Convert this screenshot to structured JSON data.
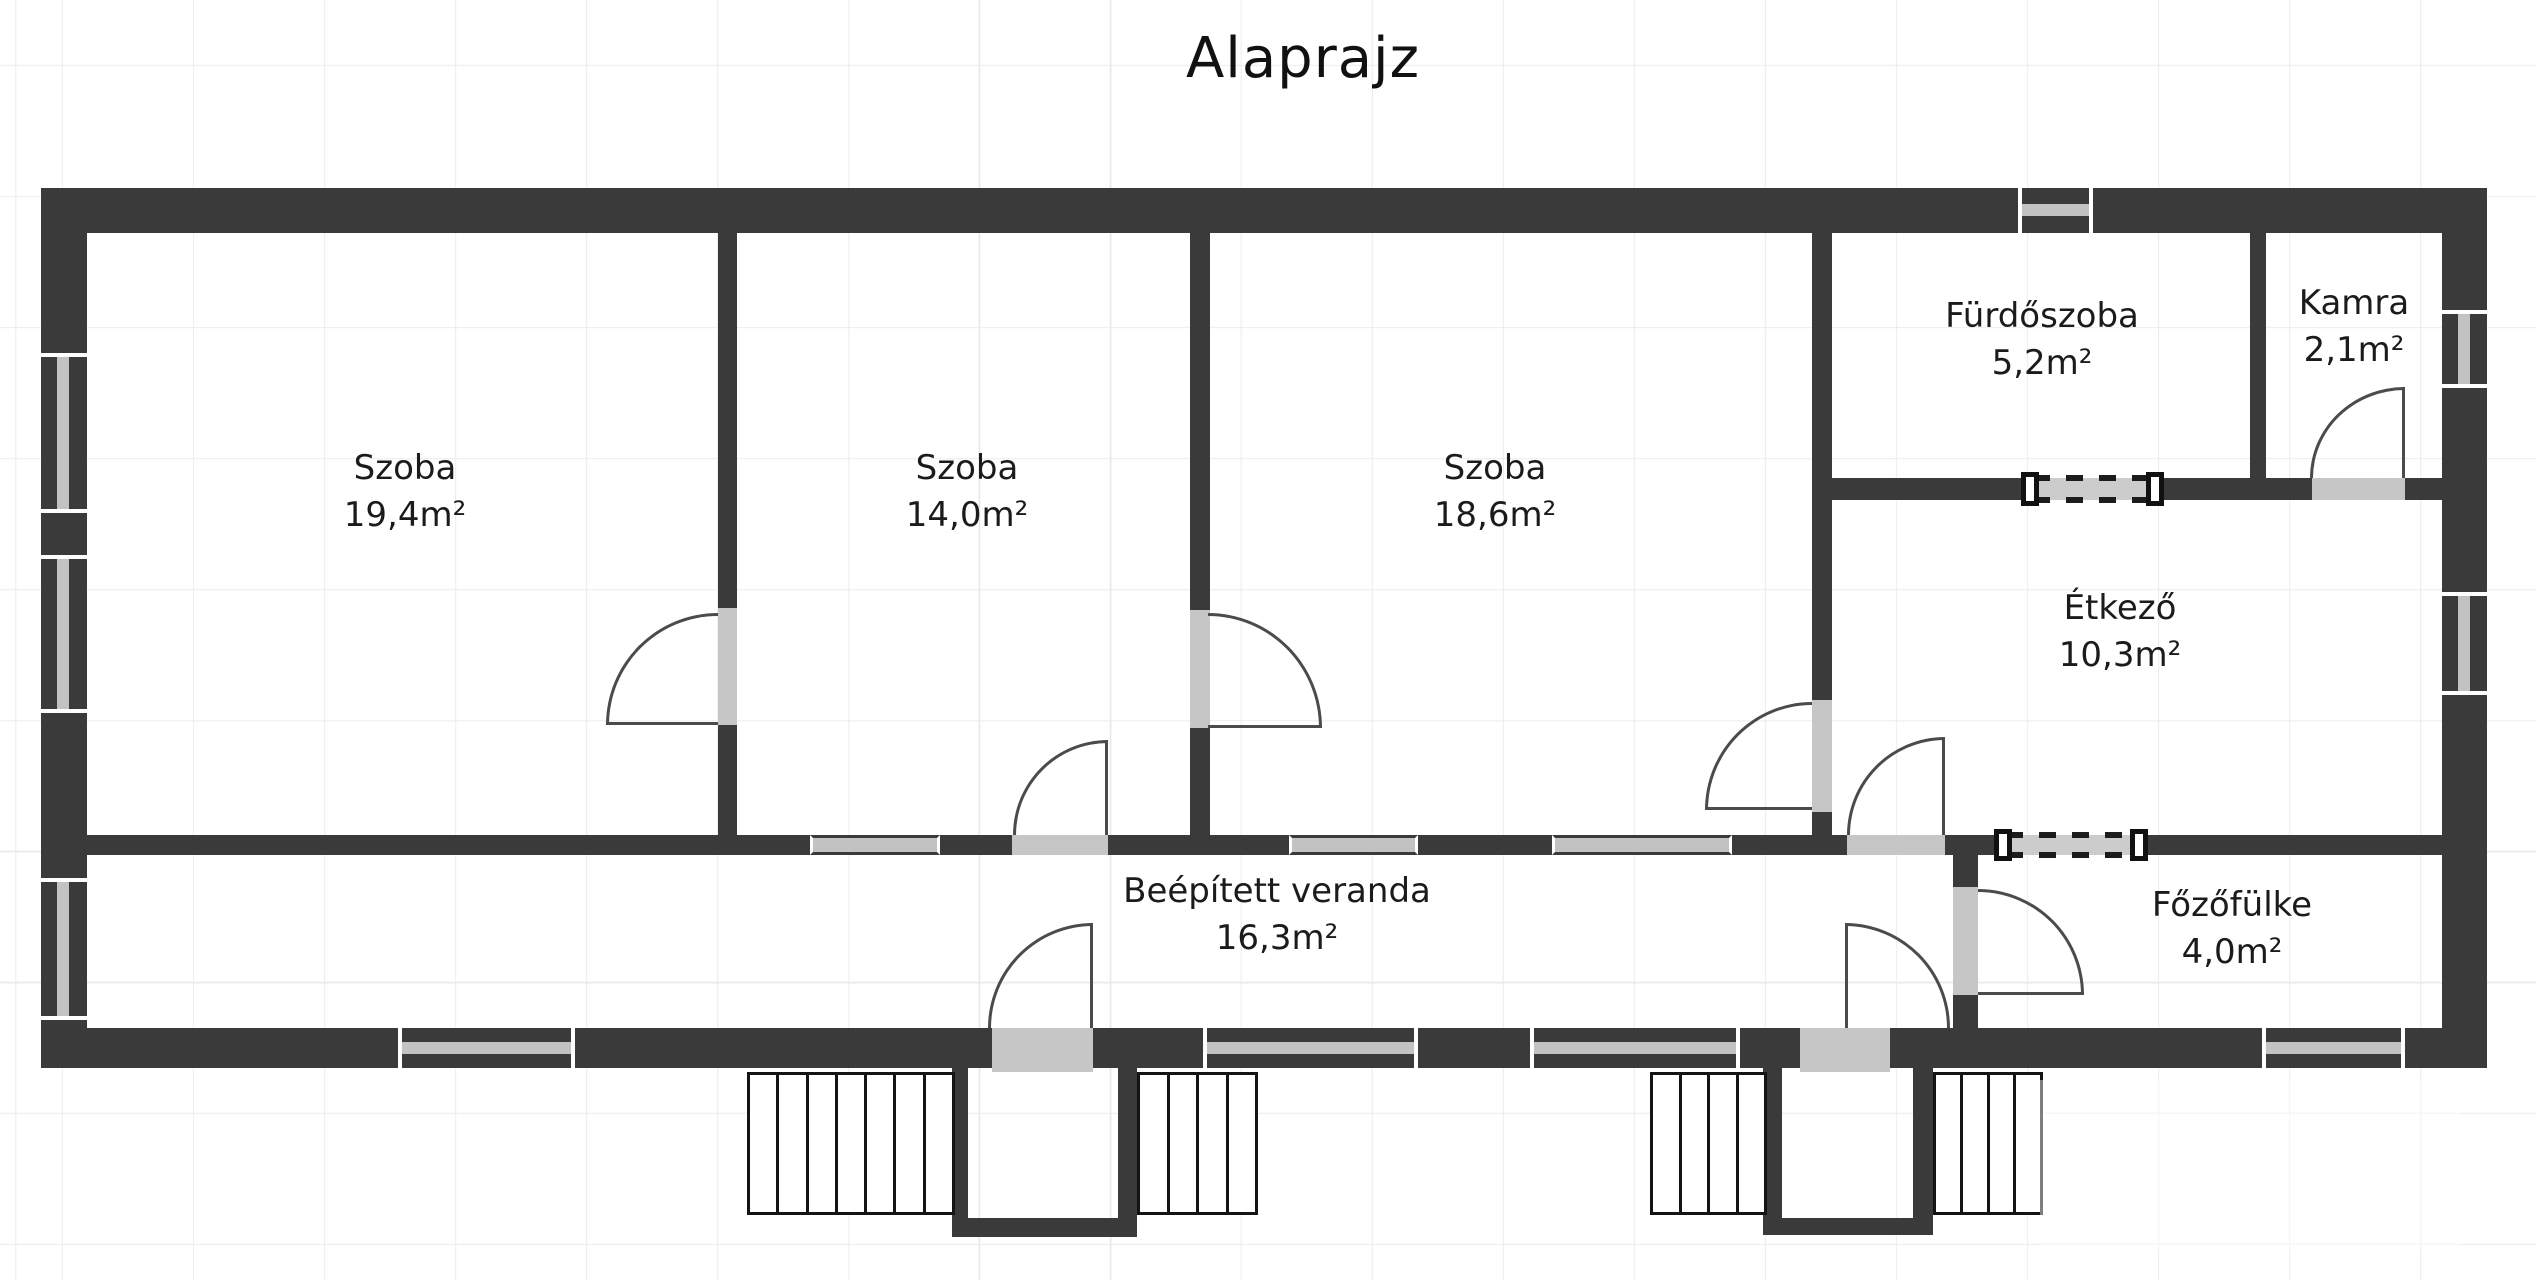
{
  "title": "Alaprajz",
  "rooms": [
    {
      "id": "szoba-1",
      "name": "Szoba",
      "area": "19,4m²"
    },
    {
      "id": "szoba-2",
      "name": "Szoba",
      "area": "14,0m²"
    },
    {
      "id": "szoba-3",
      "name": "Szoba",
      "area": "18,6m²"
    },
    {
      "id": "furdoszoba",
      "name": "Fürdőszoba",
      "area": "5,2m²"
    },
    {
      "id": "kamra",
      "name": "Kamra",
      "area": "2,1m²"
    },
    {
      "id": "etkezo",
      "name": "Étkező",
      "area": "10,3m²"
    },
    {
      "id": "veranda",
      "name": "Beépített veranda",
      "area": "16,3m²"
    },
    {
      "id": "fozofulke",
      "name": "Főzőfülke",
      "area": "4,0m²"
    }
  ],
  "colors": {
    "wall": "#3a3a3a",
    "window_glass": "#c2c2c2",
    "opening": "#c6c6c6",
    "door_arc": "#4b4b4b",
    "grid": "#e9e9e9",
    "text": "#1b1b1b"
  }
}
